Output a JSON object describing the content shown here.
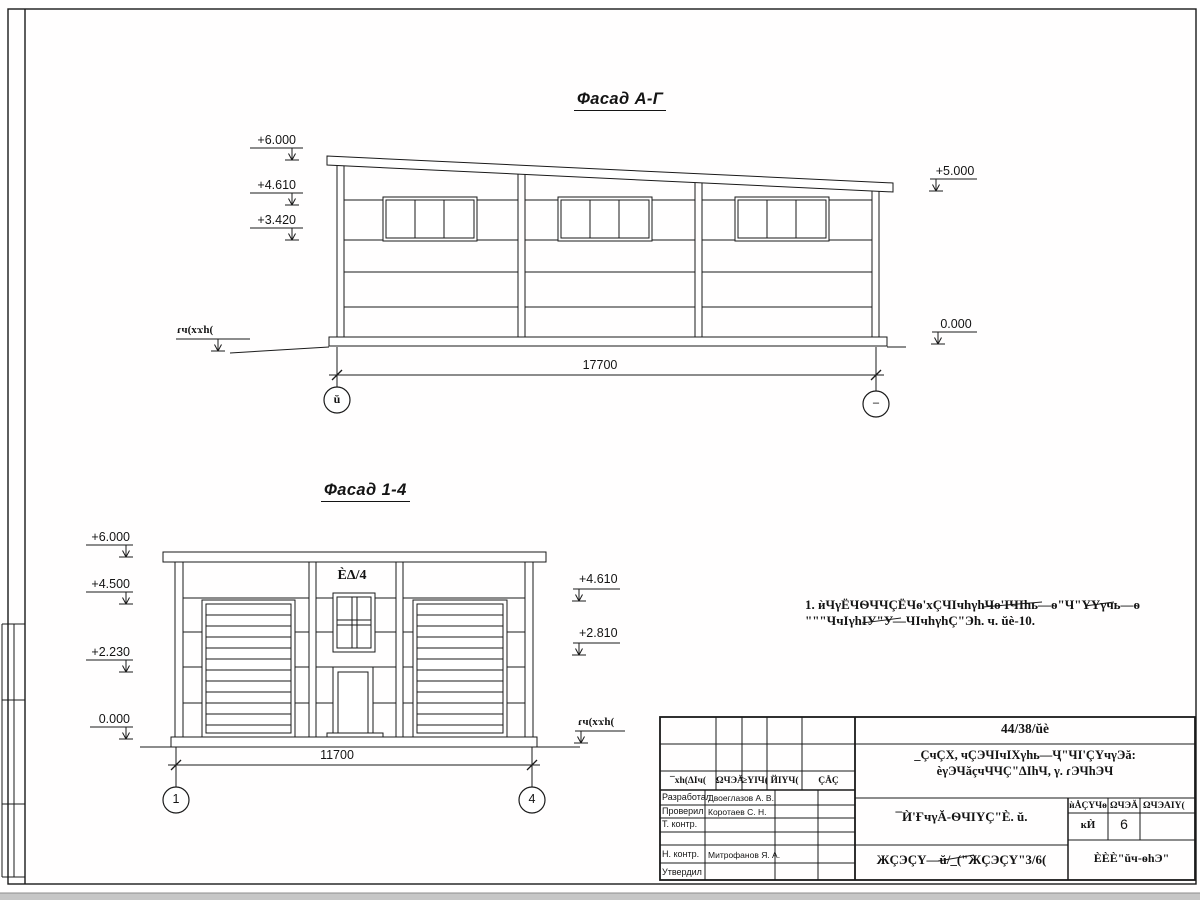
{
  "facade_ag": {
    "title": "Фасад А-Г",
    "marks_left": [
      "+6.000",
      "+4.610",
      "+3.420"
    ],
    "mark_right_top": "+5.000",
    "mark_right_bottom": "0.000",
    "ground_label": "ɾч(хϫh(",
    "dimension": "17700",
    "axis_left": "ŭ",
    "axis_right": "–"
  },
  "facade_14": {
    "title": "Фасад 1-4",
    "marks_left": [
      "+6.000",
      "+4.500",
      "+2.230",
      "0.000"
    ],
    "marks_right": [
      "+4.610",
      "+2.810"
    ],
    "ground_label": "ɾч(хϫh(",
    "door_label": "ÈΔ/4",
    "dimension": "11700",
    "axis_left": "1",
    "axis_right": "4"
  },
  "note": {
    "line1": "1. ѝЧγЁЧѲЧЧÇЁЧѳ'хÇЧІчhγhЧѳ'ІЧІhь—ѳ\"Ч\"ҮҮγчь—ѳ",
    "line2": "\"\"\"ЧчІγhІУ\"У—ЧІчhγhÇ\"Эh. ч. ŭè-10."
  },
  "title_block": {
    "doc_number": "44/38/ŭè",
    "project_line1": "_ÇчÇХ, чÇЭЧІчІХγhь—Ҷ\"ЧІ'ÇҮчγЭă:",
    "project_line2": "èγЭЧăçчЧЧÇ\"ΔІhЧ, γ. ɾЭЧhЭЧ",
    "header_cols": [
      "¯хh(ΔІч(",
      "ΩЧЭĂ",
      "≥ҮІЧ(",
      "ЙІҮЧ(",
      "ÇÅÇ"
    ],
    "rows": [
      {
        "role": "Разработал",
        "name": "Двоеглазов А. В."
      },
      {
        "role": "Проверил",
        "name": "Коротаев С. Н."
      },
      {
        "role": "Т. контр.",
        "name": ""
      },
      {
        "role": "",
        "name": ""
      },
      {
        "role": "Н. контр.",
        "name": "Митрофанов Я. А."
      },
      {
        "role": "Утвердил",
        "name": ""
      }
    ],
    "sheet_title": "¯Ѝ'ҒчγĂ-ѲЧІҮÇ\"È. ŭ.",
    "sheet_code": "ЖÇЭÇҮ—ŭ/_(\"ЖÇЭÇҮ\"3/6(",
    "stage_headers": [
      "ѝÅÇҮЧѳ",
      "ΩЧЭĂ",
      "ΩЧЭĂІҮ("
    ],
    "stage_value": "ĸЍ",
    "sheet_number": "6",
    "company": "ÈÈÈ\"ŭч-ѳhЭ\""
  }
}
